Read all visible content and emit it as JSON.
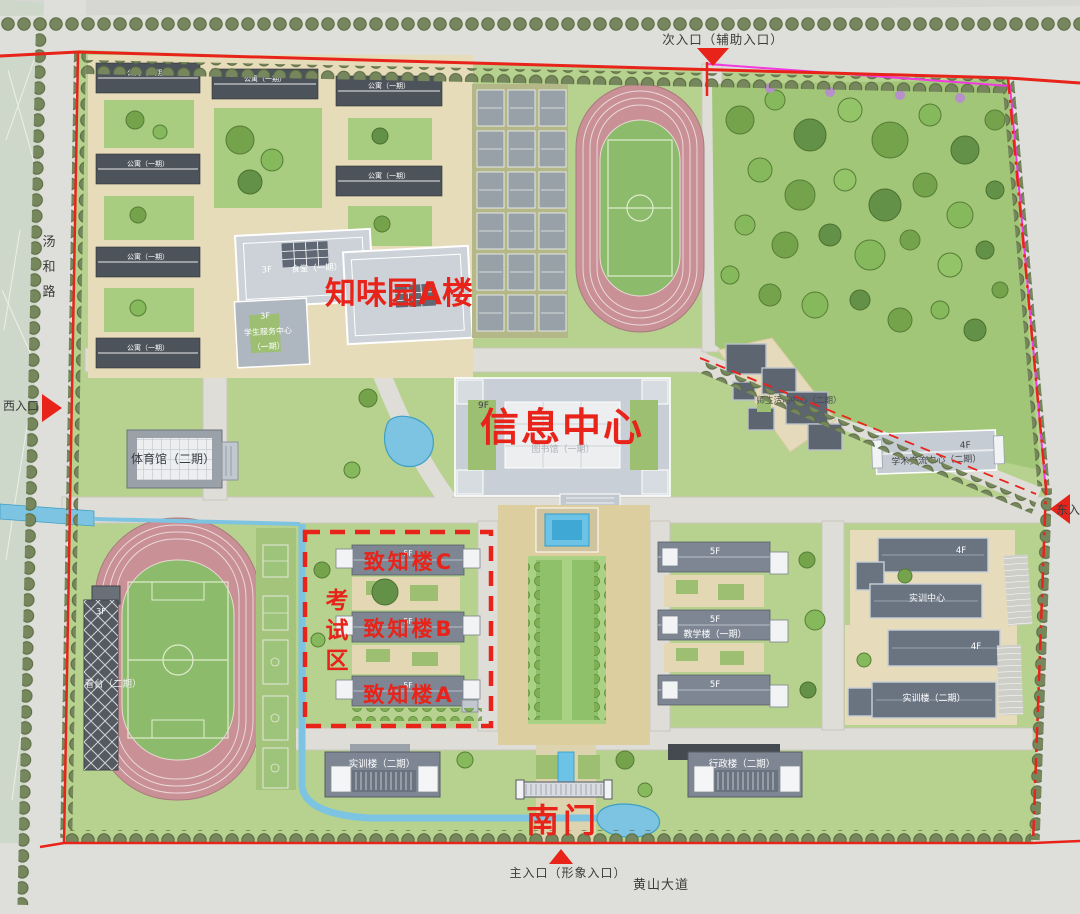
{
  "map_labels": {
    "north_entrance": "次入口（辅助入口）",
    "south_entrance": "主入口（形象入口）",
    "west_entrance": "西入口",
    "east_entrance": "东入口",
    "west_road": "汤和路",
    "west_road_chars": [
      "汤",
      "和",
      "路"
    ],
    "south_road": "黄山大道"
  },
  "red_annotations": {
    "zhiwei_building": "知味园A楼",
    "info_center": "信息中心",
    "exam_area": "考试区",
    "exam_area_chars": [
      "考",
      "试",
      "区"
    ],
    "zhizhi_c": "致知楼C",
    "zhizhi_b": "致知楼B",
    "zhizhi_a": "致知楼A",
    "south_gate": "南门"
  },
  "buildings": {
    "dorm": "公寓（一期）",
    "canteen_floors": "3F",
    "canteen": "食堂（一期）",
    "service_floors": "3F",
    "service_name": "学生服务中心",
    "service_phase": "（一期）",
    "info_floors": "9F",
    "library": "图书馆（一期）",
    "gym": "体育馆（二期）",
    "stand_floors": "3F",
    "stand": "看台（二期）",
    "zhizhi_floors": "5F",
    "teaching_floors": "5F",
    "teaching": "教学楼（一期）",
    "activity_center": "师生活动中心（二期）",
    "exchange_floors": "4F",
    "exchange_center": "学术交流中心（二期）",
    "training_center_floors": "4F",
    "training_center": "实训中心",
    "training_bldg_floors": "4F",
    "training_bldg": "实训楼（二期）",
    "southwest_bldg": "实训楼（二期）",
    "southeast_bldg": "行政楼（二期）"
  },
  "colors": {
    "annotation_red": "#e8231a",
    "campus_green": "#b7d28e",
    "road_gray": "#dedfda",
    "water_blue": "#7cc4e2",
    "track_pink": "#c99095",
    "magenta_line": "#f23ae0"
  }
}
